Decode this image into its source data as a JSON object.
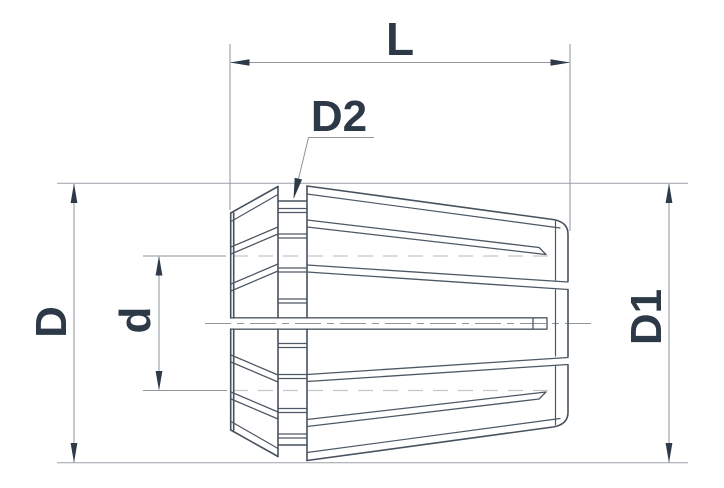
{
  "drawing": {
    "type": "technical-diagram",
    "subject": "ER collet side view with dimension callouts",
    "background": "#ffffff"
  },
  "colors": {
    "outline": "#47525e",
    "dimension_line": "#8d959d",
    "arrow": "#2e3a47",
    "label_text": "#2d3946",
    "centerline": "#8e969e",
    "hidden_bore_line": "#c3c7cc"
  },
  "labels": {
    "length": "L",
    "groove_diameter": "D2",
    "body_diameter": "D",
    "bore_diameter": "d",
    "rear_diameter": "D1"
  },
  "dimensions": [
    {
      "label": "L",
      "orientation": "horizontal",
      "position": "top",
      "arrows": "both-ends"
    },
    {
      "label": "D2",
      "orientation": "leader",
      "position": "upper-middle",
      "arrows": "single"
    },
    {
      "label": "D",
      "orientation": "vertical",
      "position": "left",
      "arrows": "both-ends"
    },
    {
      "label": "d",
      "orientation": "vertical",
      "position": "left-inner",
      "arrows": "both-ends"
    },
    {
      "label": "D1",
      "orientation": "vertical",
      "position": "right",
      "arrows": "both-ends"
    }
  ]
}
